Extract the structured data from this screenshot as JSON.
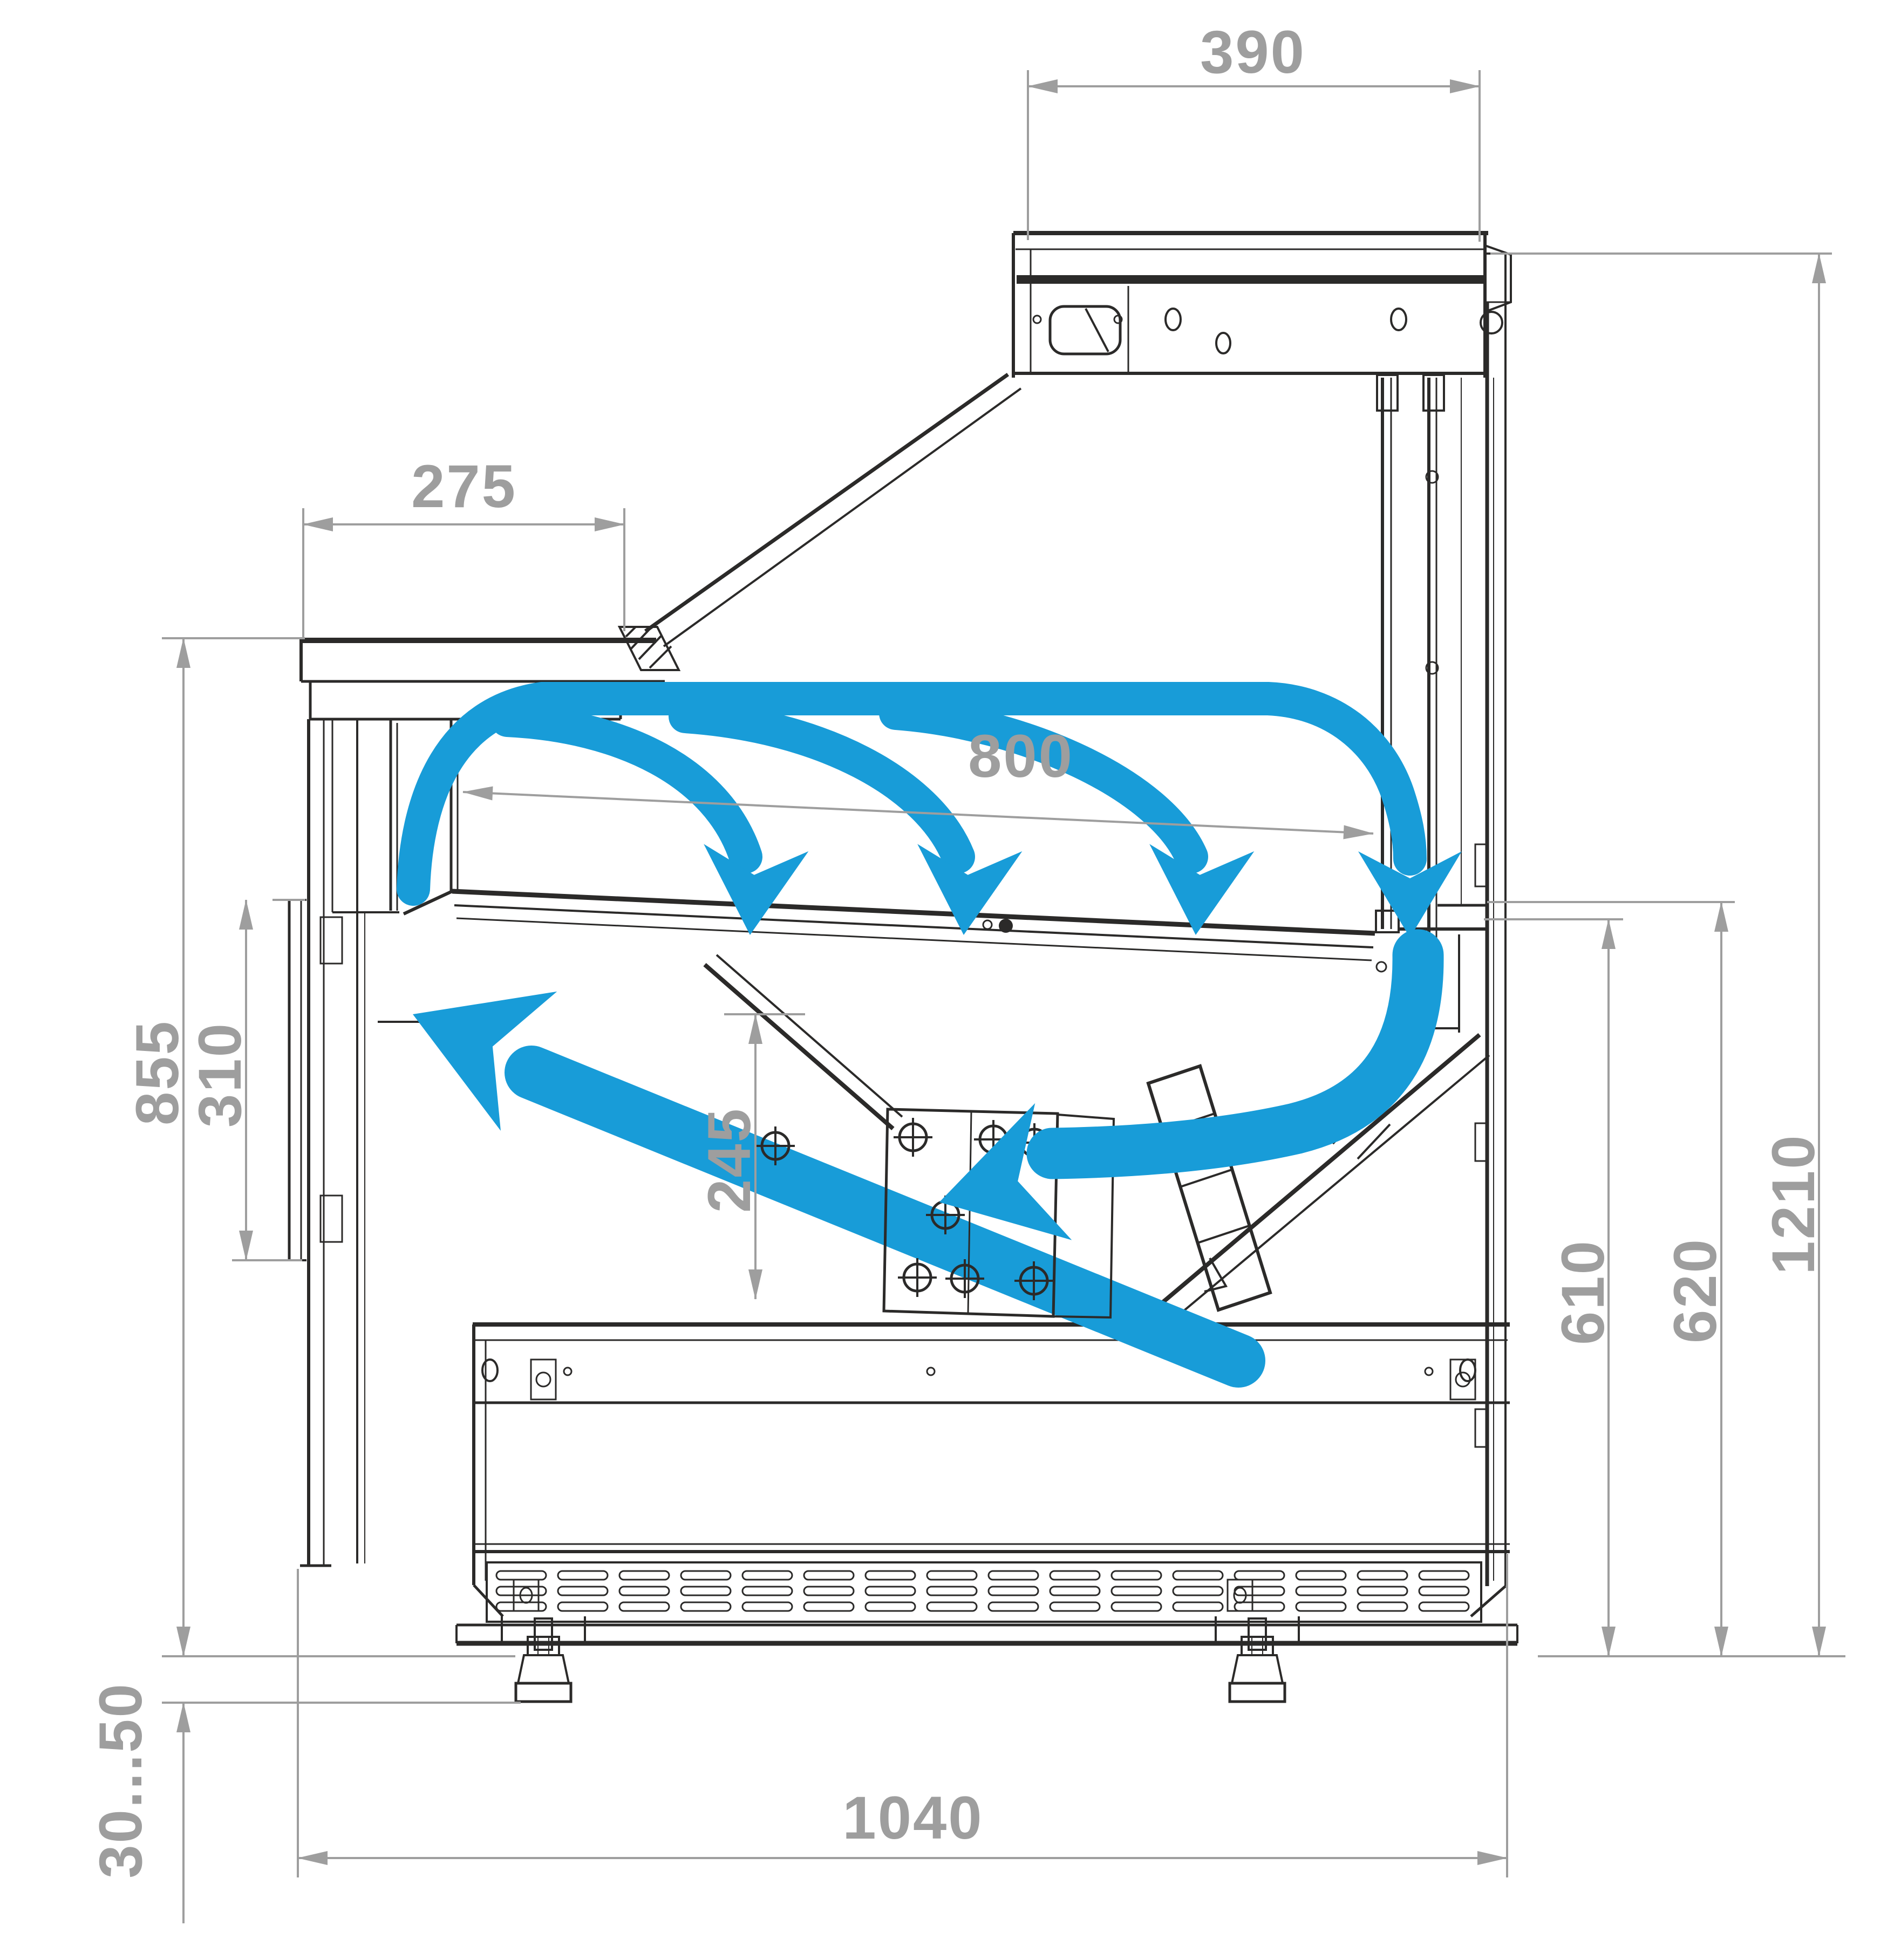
{
  "diagram": {
    "type": "technical-drawing",
    "subject": "refrigerated serve-over display counter cross-section with airflow circulation",
    "units": "mm",
    "colors": {
      "line": "#2b2a29",
      "dimension_gray": "#9e9e9e",
      "airflow_blue": "#189cd8",
      "background": "#ffffff"
    },
    "dimensions": {
      "canopy_depth": "390",
      "counter_shelf_depth": "275",
      "display_opening_width": "800",
      "front_height": "855",
      "front_panel_height": "310",
      "well_depth": "245",
      "rear_inner_height": "610",
      "rear_outer_height": "620",
      "overall_height": "1210",
      "base_depth": "1040",
      "feet_adjust_range": "30...50"
    },
    "airflow": {
      "description": "cold air curtain arcs with down arrows and return duct arrows",
      "arc_down_arrows": 4,
      "return_arrows": 2
    }
  }
}
